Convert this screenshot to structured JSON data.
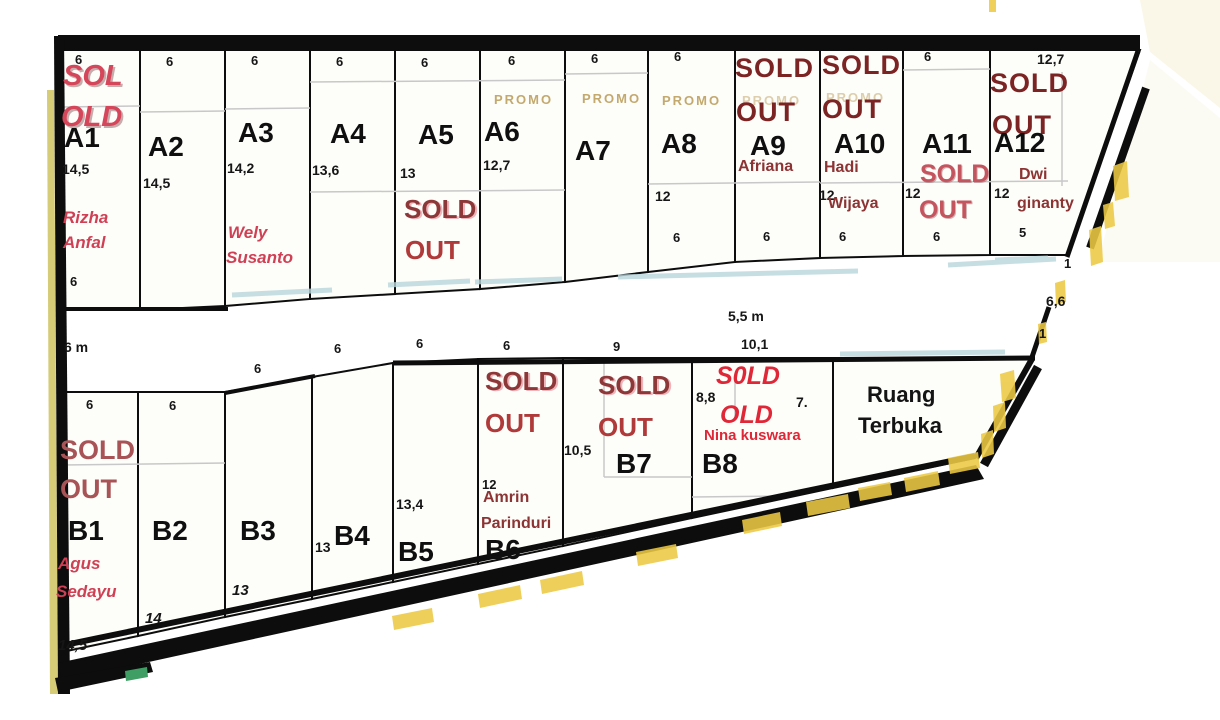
{
  "plots": {
    "a1": {
      "id": "A1",
      "top_dim": "6",
      "sold1": "SOL",
      "sold2": "OLD",
      "side_dim": "14,5",
      "owner1": "Rizha",
      "owner2": "Anfal",
      "bottom_dim": "6"
    },
    "a2": {
      "id": "A2",
      "top_dim": "6",
      "side_dim": "14,5"
    },
    "a3": {
      "id": "A3",
      "top_dim": "6",
      "side_dim": "14,2",
      "owner1": "Wely",
      "owner2": "Susanto"
    },
    "a4": {
      "id": "A4",
      "top_dim": "6",
      "side_dim": "13,6"
    },
    "a5": {
      "id": "A5",
      "top_dim": "6",
      "side_dim": "13",
      "sold1": "SOLD",
      "sold2": "OUT"
    },
    "a6": {
      "id": "A6",
      "top_dim": "6",
      "promo": "PROMO",
      "side_dim": "12,7"
    },
    "a7": {
      "id": "A7",
      "top_dim": "6",
      "promo": "PROMO"
    },
    "a8": {
      "id": "A8",
      "top_dim": "6",
      "promo": "PROMO",
      "side_dim": "12",
      "bottom_dim": "6"
    },
    "a9": {
      "id": "A9",
      "sold1": "SOLD",
      "sold2": "OUT",
      "promo": "PROMO",
      "owner1": "Afriana",
      "bottom_dim": "6"
    },
    "a10": {
      "id": "A10",
      "sold1": "SOLD",
      "sold2": "OUT",
      "promo": "PROMO",
      "owner1": "Hadi",
      "owner2": "Wijaya",
      "side_dim": "12",
      "bottom_dim": "6"
    },
    "a11": {
      "id": "A11",
      "top_dim": "6",
      "sold1": "SOLD",
      "sold2": "OUT",
      "side_dim": "12",
      "bottom_dim": "6"
    },
    "a12": {
      "id": "A12",
      "top_dim": "12,7",
      "sold1": "SOLD",
      "sold2": "OUT",
      "owner1": "Dwi",
      "owner2": "ginanty",
      "side_dim": "12",
      "bottom_dim": "5"
    },
    "b1": {
      "id": "B1",
      "top_dim": "6",
      "sold1": "SOLD",
      "sold2": "OUT",
      "owner1": "Agus",
      "owner2": "Sedayu",
      "bottom_dim": "14,5"
    },
    "b2": {
      "id": "B2",
      "top_dim": "6",
      "bottom_dim": "14"
    },
    "b3": {
      "id": "B3",
      "bottom_dim": "13"
    },
    "b4": {
      "id": "B4",
      "side_dim": "13"
    },
    "b5": {
      "id": "B5",
      "side_dim": "13,4"
    },
    "b6": {
      "id": "B6",
      "sold1": "SOLD",
      "sold2": "OUT",
      "side_dim": "12",
      "owner1": "Amrin",
      "owner2": "Parinduri"
    },
    "b7": {
      "id": "B7",
      "sold1": "SOLD",
      "sold2": "OUT",
      "side_dim": "10,5"
    },
    "b8": {
      "id": "B8",
      "sold1": "S0LD",
      "sold2": "OLD",
      "owner1": "Nina kuswara",
      "side_dim": "8,8",
      "right_dim": "7."
    }
  },
  "open_space": {
    "line1": "Ruang",
    "line2": "Terbuka"
  },
  "roads": {
    "left_road_width": "6 m",
    "main_road_width": "5,5 m",
    "frontage_dims": {
      "b3": "6",
      "b4": "6",
      "b5": "6",
      "b6": "6",
      "b7": "9",
      "b8": "10,1"
    },
    "right_edge_dims": {
      "top": "1",
      "middle": "6,6",
      "bottom": "1"
    }
  },
  "colors": {
    "sold_dark_maroon": "#7c2424",
    "sold_crimson": "#d5465a",
    "sold_brick": "#a85356",
    "bright_red": "#e02737",
    "owner_red": "#d04055",
    "owner_maroon": "#8c3434",
    "promo_tan": "#c3a96e",
    "hatch_yellow": "#ecc944",
    "teal_streak": "#b9d6dc",
    "marker_green": "#3f9e63",
    "line_black": "#0d0d0d",
    "plot_fill": "#fdfdf9"
  }
}
